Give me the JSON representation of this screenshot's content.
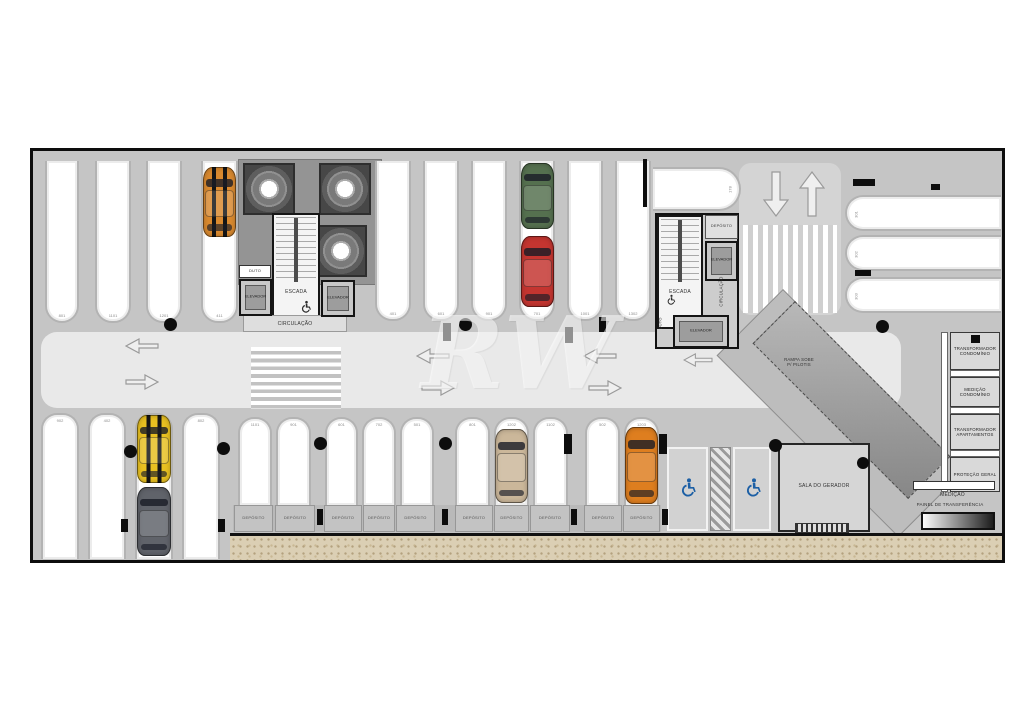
{
  "title_watermark": "RW",
  "colors": {
    "floor": "#c5c5c5",
    "aisle": "#e9e9e9",
    "stall": "#ffffff",
    "wall": "#0d0d0d",
    "accessible_blue": "#1c5fa5",
    "sand": "#dbcfb4",
    "car_orange": "#d9892f",
    "car_green": "#55704f",
    "car_red": "#c43530",
    "car_yellow": "#e8c021",
    "car_gray": "#60636a",
    "car_tan": "#cbb79a",
    "car_amber": "#de7e1f"
  },
  "core_left": {
    "duto": "DUTO",
    "elevator_left": "ELEVADOR",
    "elevator_right": "ELEVADOR",
    "stairs": "ESCADA",
    "circulation": "CIRCULAÇÃO"
  },
  "core_right": {
    "storage": "DEPÓSITO",
    "elevator_side": "ELEVADOR",
    "elevator_bottom": "ELEVADOR",
    "stairs": "ESCADA",
    "circulation": "CIRCULAÇÃO",
    "duto": "DUTO",
    "stall_number": "178"
  },
  "ramp": {
    "line1": "RAMPA SOBE",
    "line2": "P/ PILOTIS"
  },
  "generator_room": "SALA DO GERADOR",
  "electrical_rooms": [
    "TRANSFORMADOR CONDOMÍNIO",
    "MEDIÇÃO CONDOMÍNIO",
    "TRANSFORMADOR APARTAMENTOS",
    "PROTEÇÃO GERAL"
  ],
  "electrical_bottom": {
    "medicao": "MEDIÇÃO",
    "painel": "PAINEL DE TRANSFERÊNCIA"
  },
  "storage_units": [
    "DEPÓSITO",
    "DEPÓSITO",
    "DEPÓSITO",
    "DEPÓSITO",
    "DEPÓSITO",
    "DEPÓSITO",
    "DEPÓSITO",
    "DEPÓSITO",
    "DEPÓSITO",
    "DEPÓSITO"
  ],
  "stall_numbers": {
    "top_left": [
      "801",
      "1101",
      "1201",
      "411"
    ],
    "top_middle": [
      "401",
      "601",
      "901",
      "701",
      "1001",
      "1302"
    ],
    "right_side": [
      "301",
      "302",
      "303"
    ],
    "bottom_left": [
      "902",
      "402",
      "1002",
      "802"
    ],
    "bottom_middle": [
      "1101",
      "901",
      "601",
      "702",
      "501",
      "801",
      "1202",
      "1102",
      "502",
      "1203"
    ]
  }
}
